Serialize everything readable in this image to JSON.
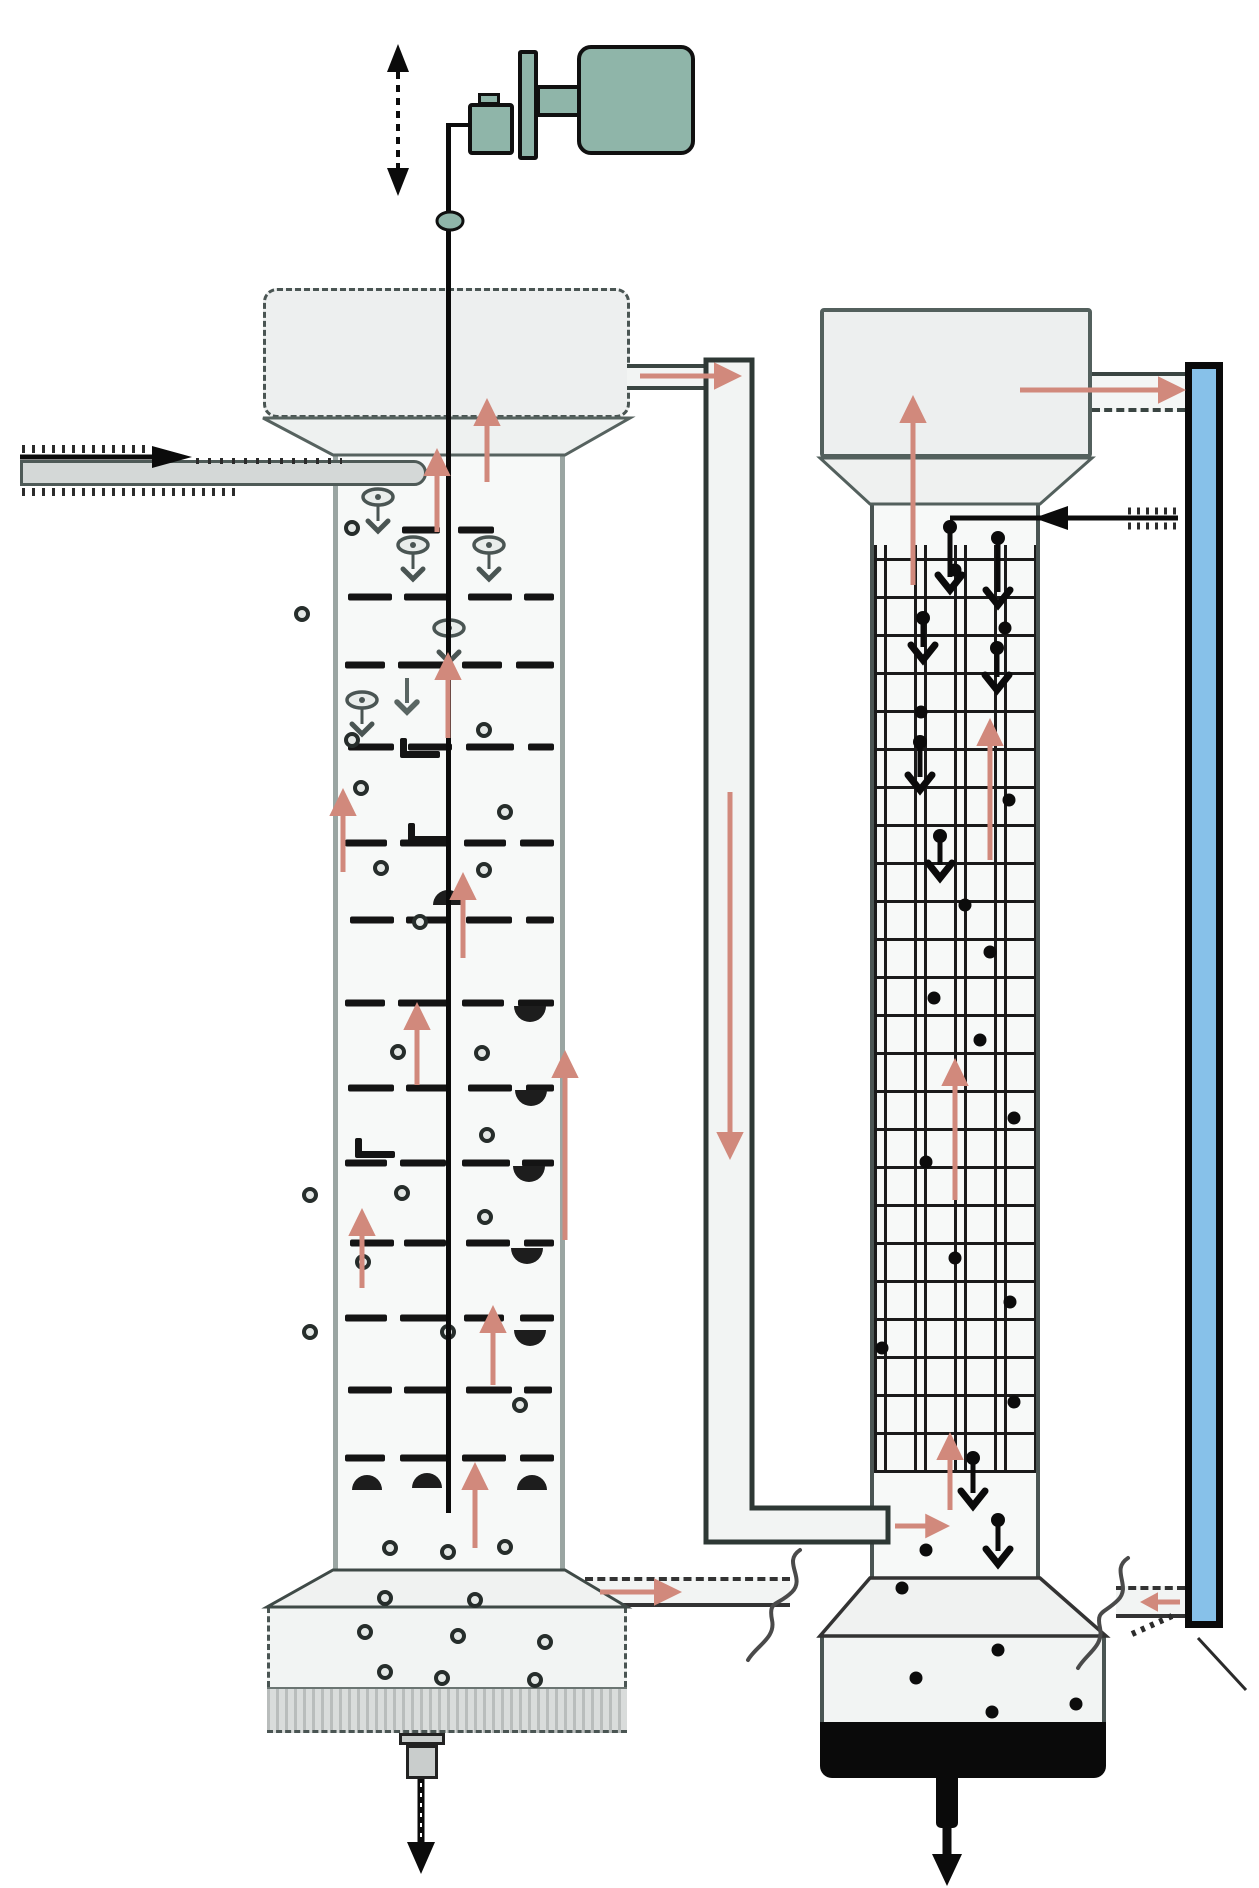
{
  "meta": {
    "description": "Process flow diagram of two coupled extraction columns: a pulsed sieve-plate column (left, with reciprocating drive motor) and a packed/grid column (right) connected by a downcomer pipe and an external blue riser line. No text labels are rendered in the image.",
    "canvas": {
      "w": 1259,
      "h": 1888
    }
  },
  "colors": {
    "teal": "#8FB5A9",
    "salmon": "#D1897C",
    "blue": "#87C1E9",
    "ink": "#0A0A0A",
    "wallDark": "#4A5553",
    "wallMid": "#9AA5A2",
    "fillHeader": "#EDEFEF",
    "fillBody": "#F7F9F8",
    "fillPipe": "#F2F4F3",
    "bandGray": "#D9DCDB",
    "pipeGray": "#D4D8D7",
    "grid": "#1A1A1A",
    "glyphGray": "#4A5553",
    "plate": "#141414"
  },
  "annotations": {
    "plates": {
      "thickness": 7,
      "rows": [
        {
          "y": 530,
          "segs": [
            [
              402,
              38
            ],
            [
              458,
              36
            ]
          ]
        },
        {
          "y": 597,
          "segs": [
            [
              348,
              44
            ],
            [
              404,
              46
            ],
            [
              468,
              44
            ],
            [
              524,
              30
            ]
          ]
        },
        {
          "y": 665,
          "segs": [
            [
              345,
              40
            ],
            [
              398,
              52
            ],
            [
              462,
              40
            ],
            [
              516,
              38
            ]
          ]
        },
        {
          "y": 747,
          "segs": [
            [
              348,
              46
            ],
            [
              408,
              44
            ],
            [
              466,
              48
            ],
            [
              528,
              26
            ]
          ]
        },
        {
          "y": 843,
          "segs": [
            [
              345,
              42
            ],
            [
              400,
              48
            ],
            [
              464,
              42
            ],
            [
              520,
              34
            ]
          ]
        },
        {
          "y": 920,
          "segs": [
            [
              350,
              44
            ],
            [
              406,
              42
            ],
            [
              466,
              46
            ],
            [
              526,
              28
            ]
          ]
        },
        {
          "y": 1003,
          "segs": [
            [
              345,
              40
            ],
            [
              398,
              50
            ],
            [
              462,
              42
            ],
            [
              518,
              36
            ]
          ]
        },
        {
          "y": 1088,
          "segs": [
            [
              348,
              46
            ],
            [
              406,
              44
            ],
            [
              468,
              44
            ],
            [
              526,
              28
            ]
          ]
        },
        {
          "y": 1163,
          "segs": [
            [
              345,
              42
            ],
            [
              400,
              46
            ],
            [
              462,
              48
            ],
            [
              522,
              32
            ]
          ]
        },
        {
          "y": 1243,
          "segs": [
            [
              350,
              44
            ],
            [
              404,
              42
            ],
            [
              466,
              44
            ],
            [
              524,
              30
            ]
          ]
        },
        {
          "y": 1318,
          "segs": [
            [
              345,
              42
            ],
            [
              400,
              50
            ],
            [
              464,
              40
            ],
            [
              520,
              34
            ]
          ]
        },
        {
          "y": 1390,
          "segs": [
            [
              348,
              44
            ],
            [
              404,
              44
            ],
            [
              466,
              46
            ],
            [
              524,
              28
            ]
          ]
        },
        {
          "y": 1458,
          "segs": [
            [
              345,
              40
            ],
            [
              400,
              48
            ],
            [
              462,
              44
            ],
            [
              520,
              34
            ]
          ]
        }
      ]
    },
    "hooks": [
      [
        400,
        755
      ],
      [
        408,
        840
      ],
      [
        355,
        1155
      ]
    ],
    "dots_ring": [
      [
        352,
        528
      ],
      [
        302,
        614
      ],
      [
        352,
        740
      ],
      [
        361,
        788
      ],
      [
        381,
        868
      ],
      [
        484,
        730
      ],
      [
        505,
        812
      ],
      [
        484,
        870
      ],
      [
        420,
        922
      ],
      [
        398,
        1052
      ],
      [
        482,
        1053
      ],
      [
        487,
        1135
      ],
      [
        310,
        1195
      ],
      [
        402,
        1193
      ],
      [
        485,
        1217
      ],
      [
        363,
        1262
      ],
      [
        310,
        1332
      ],
      [
        448,
        1332
      ],
      [
        520,
        1405
      ],
      [
        390,
        1548
      ],
      [
        448,
        1552
      ],
      [
        505,
        1547
      ],
      [
        385,
        1598
      ],
      [
        475,
        1600
      ],
      [
        365,
        1632
      ],
      [
        458,
        1636
      ],
      [
        545,
        1642
      ],
      [
        385,
        1672
      ],
      [
        442,
        1678
      ],
      [
        535,
        1680
      ]
    ],
    "dots_solid": [
      [
        955,
        570
      ],
      [
        1005,
        628
      ],
      [
        921,
        712
      ],
      [
        1009,
        800
      ],
      [
        965,
        905
      ],
      [
        990,
        952
      ],
      [
        934,
        998
      ],
      [
        980,
        1040
      ],
      [
        1014,
        1118
      ],
      [
        926,
        1162
      ],
      [
        955,
        1258
      ],
      [
        1010,
        1302
      ],
      [
        882,
        1348
      ],
      [
        1014,
        1402
      ],
      [
        926,
        1550
      ],
      [
        902,
        1588
      ],
      [
        916,
        1678
      ],
      [
        998,
        1650
      ],
      [
        1076,
        1704
      ],
      [
        992,
        1712
      ]
    ],
    "droplet_glyphs": [
      [
        378,
        497
      ],
      [
        413,
        545
      ],
      [
        489,
        545
      ],
      [
        449,
        628
      ],
      [
        362,
        700
      ]
    ],
    "gray_chevrons": [
      [
        407,
        678,
        712
      ]
    ],
    "half_drops_down": [
      [
        530,
        1006
      ],
      [
        531,
        1090
      ],
      [
        529,
        1166
      ],
      [
        527,
        1248
      ],
      [
        530,
        1330
      ]
    ],
    "half_drops_up": [
      [
        367,
        1490
      ],
      [
        427,
        1488
      ],
      [
        532,
        1490
      ],
      [
        448,
        905
      ]
    ],
    "drive_rod": {
      "x": 446,
      "y1": 123,
      "y2": 1513,
      "w": 5,
      "elbowX2": 470
    },
    "coupler": {
      "x": 450,
      "y": 221,
      "rx": 13,
      "ry": 9
    },
    "pulse_arrow": {
      "x": 398,
      "tipTop": 44,
      "tipBottom": 196,
      "headW": 22,
      "headH": 28
    },
    "feed_arrow": {
      "y": 457,
      "x1": 20,
      "tipX": 192
    },
    "rc_feed_line": {
      "y": 518,
      "x1": 950,
      "x2": 1178,
      "tipX": 1034
    },
    "salmon_arrows": [
      [
        487,
        482,
        487,
        398
      ],
      [
        437,
        532,
        437,
        448
      ],
      [
        448,
        738,
        448,
        652
      ],
      [
        343,
        872,
        343,
        788
      ],
      [
        463,
        958,
        463,
        872
      ],
      [
        565,
        1240,
        565,
        1050
      ],
      [
        417,
        1085,
        417,
        1002
      ],
      [
        362,
        1288,
        362,
        1208
      ],
      [
        493,
        1385,
        493,
        1305
      ],
      [
        475,
        1548,
        475,
        1462
      ],
      [
        913,
        585,
        913,
        395
      ],
      [
        990,
        860,
        990,
        718
      ],
      [
        955,
        1200,
        955,
        1058
      ],
      [
        950,
        1510,
        950,
        1432
      ],
      [
        730,
        792,
        730,
        1160
      ],
      [
        640,
        376,
        742,
        376
      ],
      [
        1020,
        390,
        1186,
        390
      ],
      [
        600,
        1592,
        682,
        1592
      ],
      [
        895,
        1526,
        950,
        1526
      ],
      [
        1180,
        1602,
        1140,
        1602
      ]
    ],
    "black_drop_arrows": [
      [
        950,
        527,
        590
      ],
      [
        998,
        538,
        605
      ],
      [
        923,
        618,
        660
      ],
      [
        997,
        648,
        690
      ],
      [
        920,
        742,
        790
      ],
      [
        940,
        836,
        878
      ],
      [
        973,
        1458,
        1506
      ],
      [
        998,
        1520,
        1564
      ]
    ],
    "drain_arrows": [
      {
        "x": 421,
        "y1": 1779,
        "y2": 1874,
        "shaftW": 7,
        "headW": 28,
        "hatched": true
      },
      {
        "x": 947,
        "y1": 1826,
        "y2": 1886,
        "shaftW": 9,
        "headW": 30,
        "hatched": false
      }
    ],
    "hatch_lines": [
      [
        22,
        449,
        148,
        449,
        8,
        "3 7"
      ],
      [
        22,
        492,
        238,
        492,
        8,
        "3 7"
      ],
      [
        196,
        461,
        342,
        461,
        6,
        "3 9"
      ],
      [
        1128,
        511,
        1178,
        511,
        7,
        "3 6"
      ],
      [
        1128,
        526,
        1178,
        526,
        7,
        "3 6"
      ],
      [
        1132,
        1634,
        1172,
        1616,
        6,
        "4 6"
      ],
      [
        1198,
        1638,
        1246,
        1690,
        3,
        ""
      ]
    ],
    "squiggles": [
      {
        "d": "M 800 1550 C 782 1562, 806 1578, 792 1592 C 778 1606, 768 1600, 772 1620 C 776 1638, 756 1646, 748 1660",
        "w": 4
      },
      {
        "d": "M 1128 1558 C 1110 1570, 1132 1586, 1118 1600 C 1104 1614, 1096 1610, 1100 1628 C 1104 1646, 1086 1654, 1078 1668",
        "w": 4
      }
    ]
  }
}
